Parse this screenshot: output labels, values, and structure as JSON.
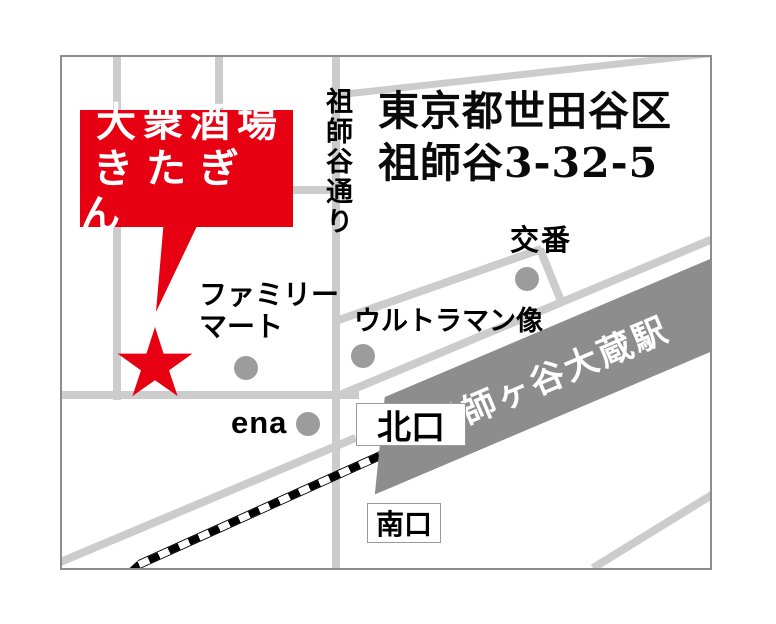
{
  "map": {
    "callout": {
      "line1": "大衆酒場",
      "line2": "きたぎん"
    },
    "address": {
      "line1": "東京都世田谷区",
      "line2": "祖師谷3-32-5"
    },
    "street_label": "祖師谷通り",
    "station_label": "祖師ヶ谷大蔵駅",
    "landmarks": {
      "koban": "交番",
      "familymart_line1": "ファミリー",
      "familymart_line2": "マート",
      "ultraman": "ウルトラマン像",
      "ena": "ena"
    },
    "exits": {
      "north": "北口",
      "south": "南口"
    },
    "colors": {
      "accent_red": "#e60012",
      "road_gray": "#cccccc",
      "station_gray": "#8d8d8d",
      "dot_gray": "#9c9c9c",
      "border_gray": "#8d8d8d"
    }
  }
}
